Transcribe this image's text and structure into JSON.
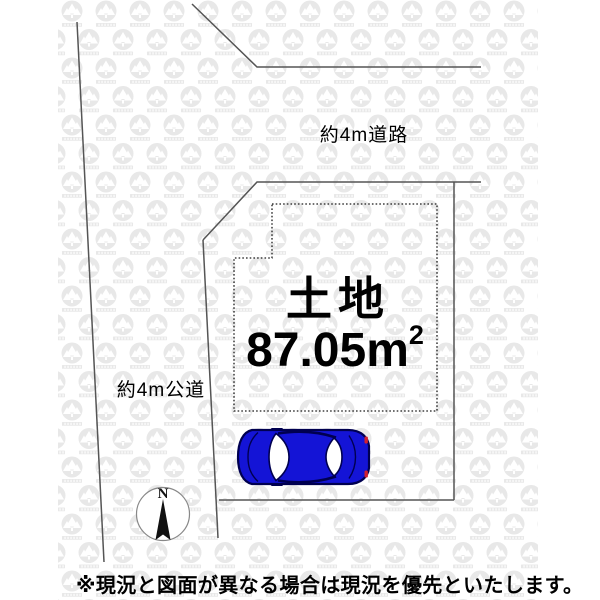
{
  "diagram": {
    "roads": {
      "top_label": "約4m道路",
      "left_label": "約4m公道"
    },
    "parcel": {
      "title": "土地",
      "area_value": "87.05",
      "area_unit": "m",
      "area_exponent": "2"
    },
    "compass": {
      "north_label": "N"
    },
    "footnote": "※現況と図面が異なる場合は現況を優先といたします。",
    "colors": {
      "boundary_line": "#555555",
      "dashed_outline": "#1a1a1a",
      "watermark_gray": "#e8e8e8",
      "car_body_blue": "#1414d6",
      "car_outline": "#000050",
      "taillight_red": "#d02030"
    }
  }
}
